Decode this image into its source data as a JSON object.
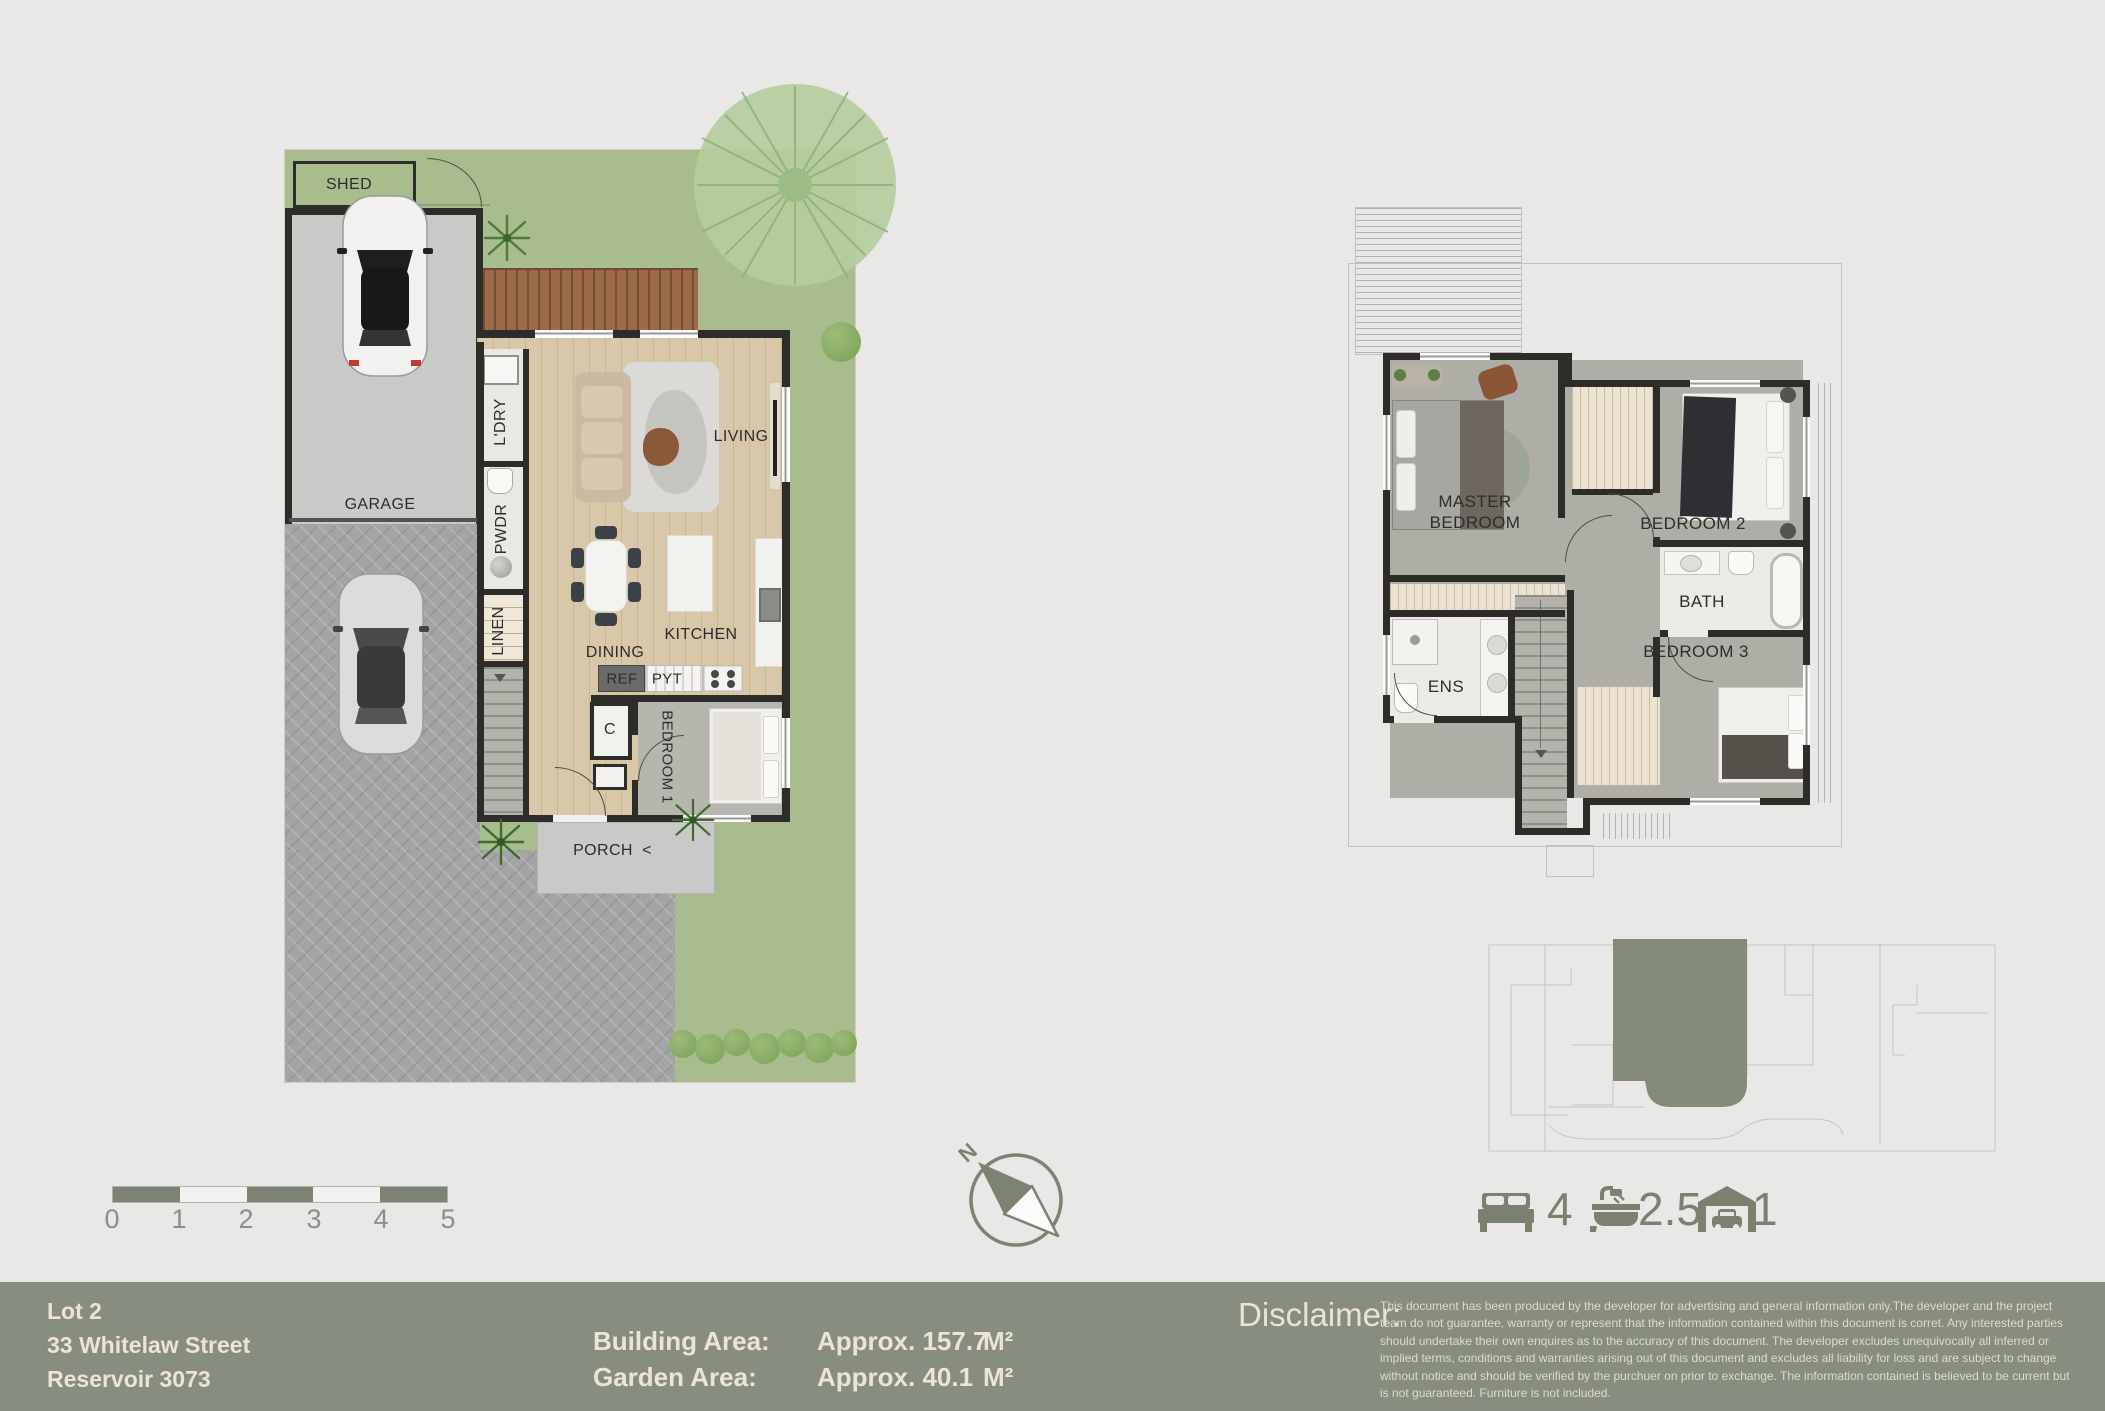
{
  "colors": {
    "accent": "#7d8373",
    "footer_bg": "#878d7f",
    "grass": "#a8bc8e",
    "cream": "#ece5d3",
    "wall": "#2e2c29"
  },
  "ground_floor": {
    "labels": {
      "shed": "SHED",
      "garage": "GARAGE",
      "laundry": "L'DRY",
      "powder": "PWDR",
      "linen": "LINEN",
      "living": "LIVING",
      "dining": "DINING",
      "kitchen": "KITCHEN",
      "ref": "REF",
      "pantry": "PYT",
      "closet": "C",
      "bedroom1": "BEDROOM 1",
      "porch": "PORCH",
      "porch_arrow": "<"
    }
  },
  "upper_floor": {
    "labels": {
      "master": "MASTER BEDROOM",
      "bedroom2": "BEDROOM 2",
      "bath": "BATH",
      "bedroom3": "BEDROOM 3",
      "ens": "ENS"
    }
  },
  "scale_bar": {
    "ticks": [
      "0",
      "1",
      "2",
      "3",
      "4",
      "5"
    ]
  },
  "compass": {
    "north": "N"
  },
  "summary": {
    "items": [
      {
        "name": "bedrooms",
        "icon": "bed-icon",
        "value": "4"
      },
      {
        "name": "bathrooms",
        "icon": "bath-icon",
        "value": "2.5"
      },
      {
        "name": "garage",
        "icon": "car-icon",
        "value": "1"
      }
    ]
  },
  "footer": {
    "lot": "Lot 2",
    "street": "33 Whitelaw Street",
    "suburb": "Reservoir 3073",
    "building_area_label": "Building Area:",
    "building_area_value": "Approx. 157.7",
    "building_area_unit": "M²",
    "garden_area_label": "Garden Area:",
    "garden_area_value": "Approx. 40.1",
    "garden_area_unit": "M²",
    "disclaimer_label": "Disclaimer:",
    "disclaimer_text": "This document has been produced by the developer for advertising and general information only.The developer and the project team do not guarantee, warranty or represent that the information contained within this document is corret. Any interested parties should undertake their own enquires as to the accuracy of this document. The developer excludes unequivocally all inferred or implied terms, conditions and warranties arising out of this document and excludes all liability for loss and are subject to change without notice and should be verified by the purchuer on prior to exchange. The information contained is believed to be current but is not guaranteed. Furniture is not included."
  }
}
